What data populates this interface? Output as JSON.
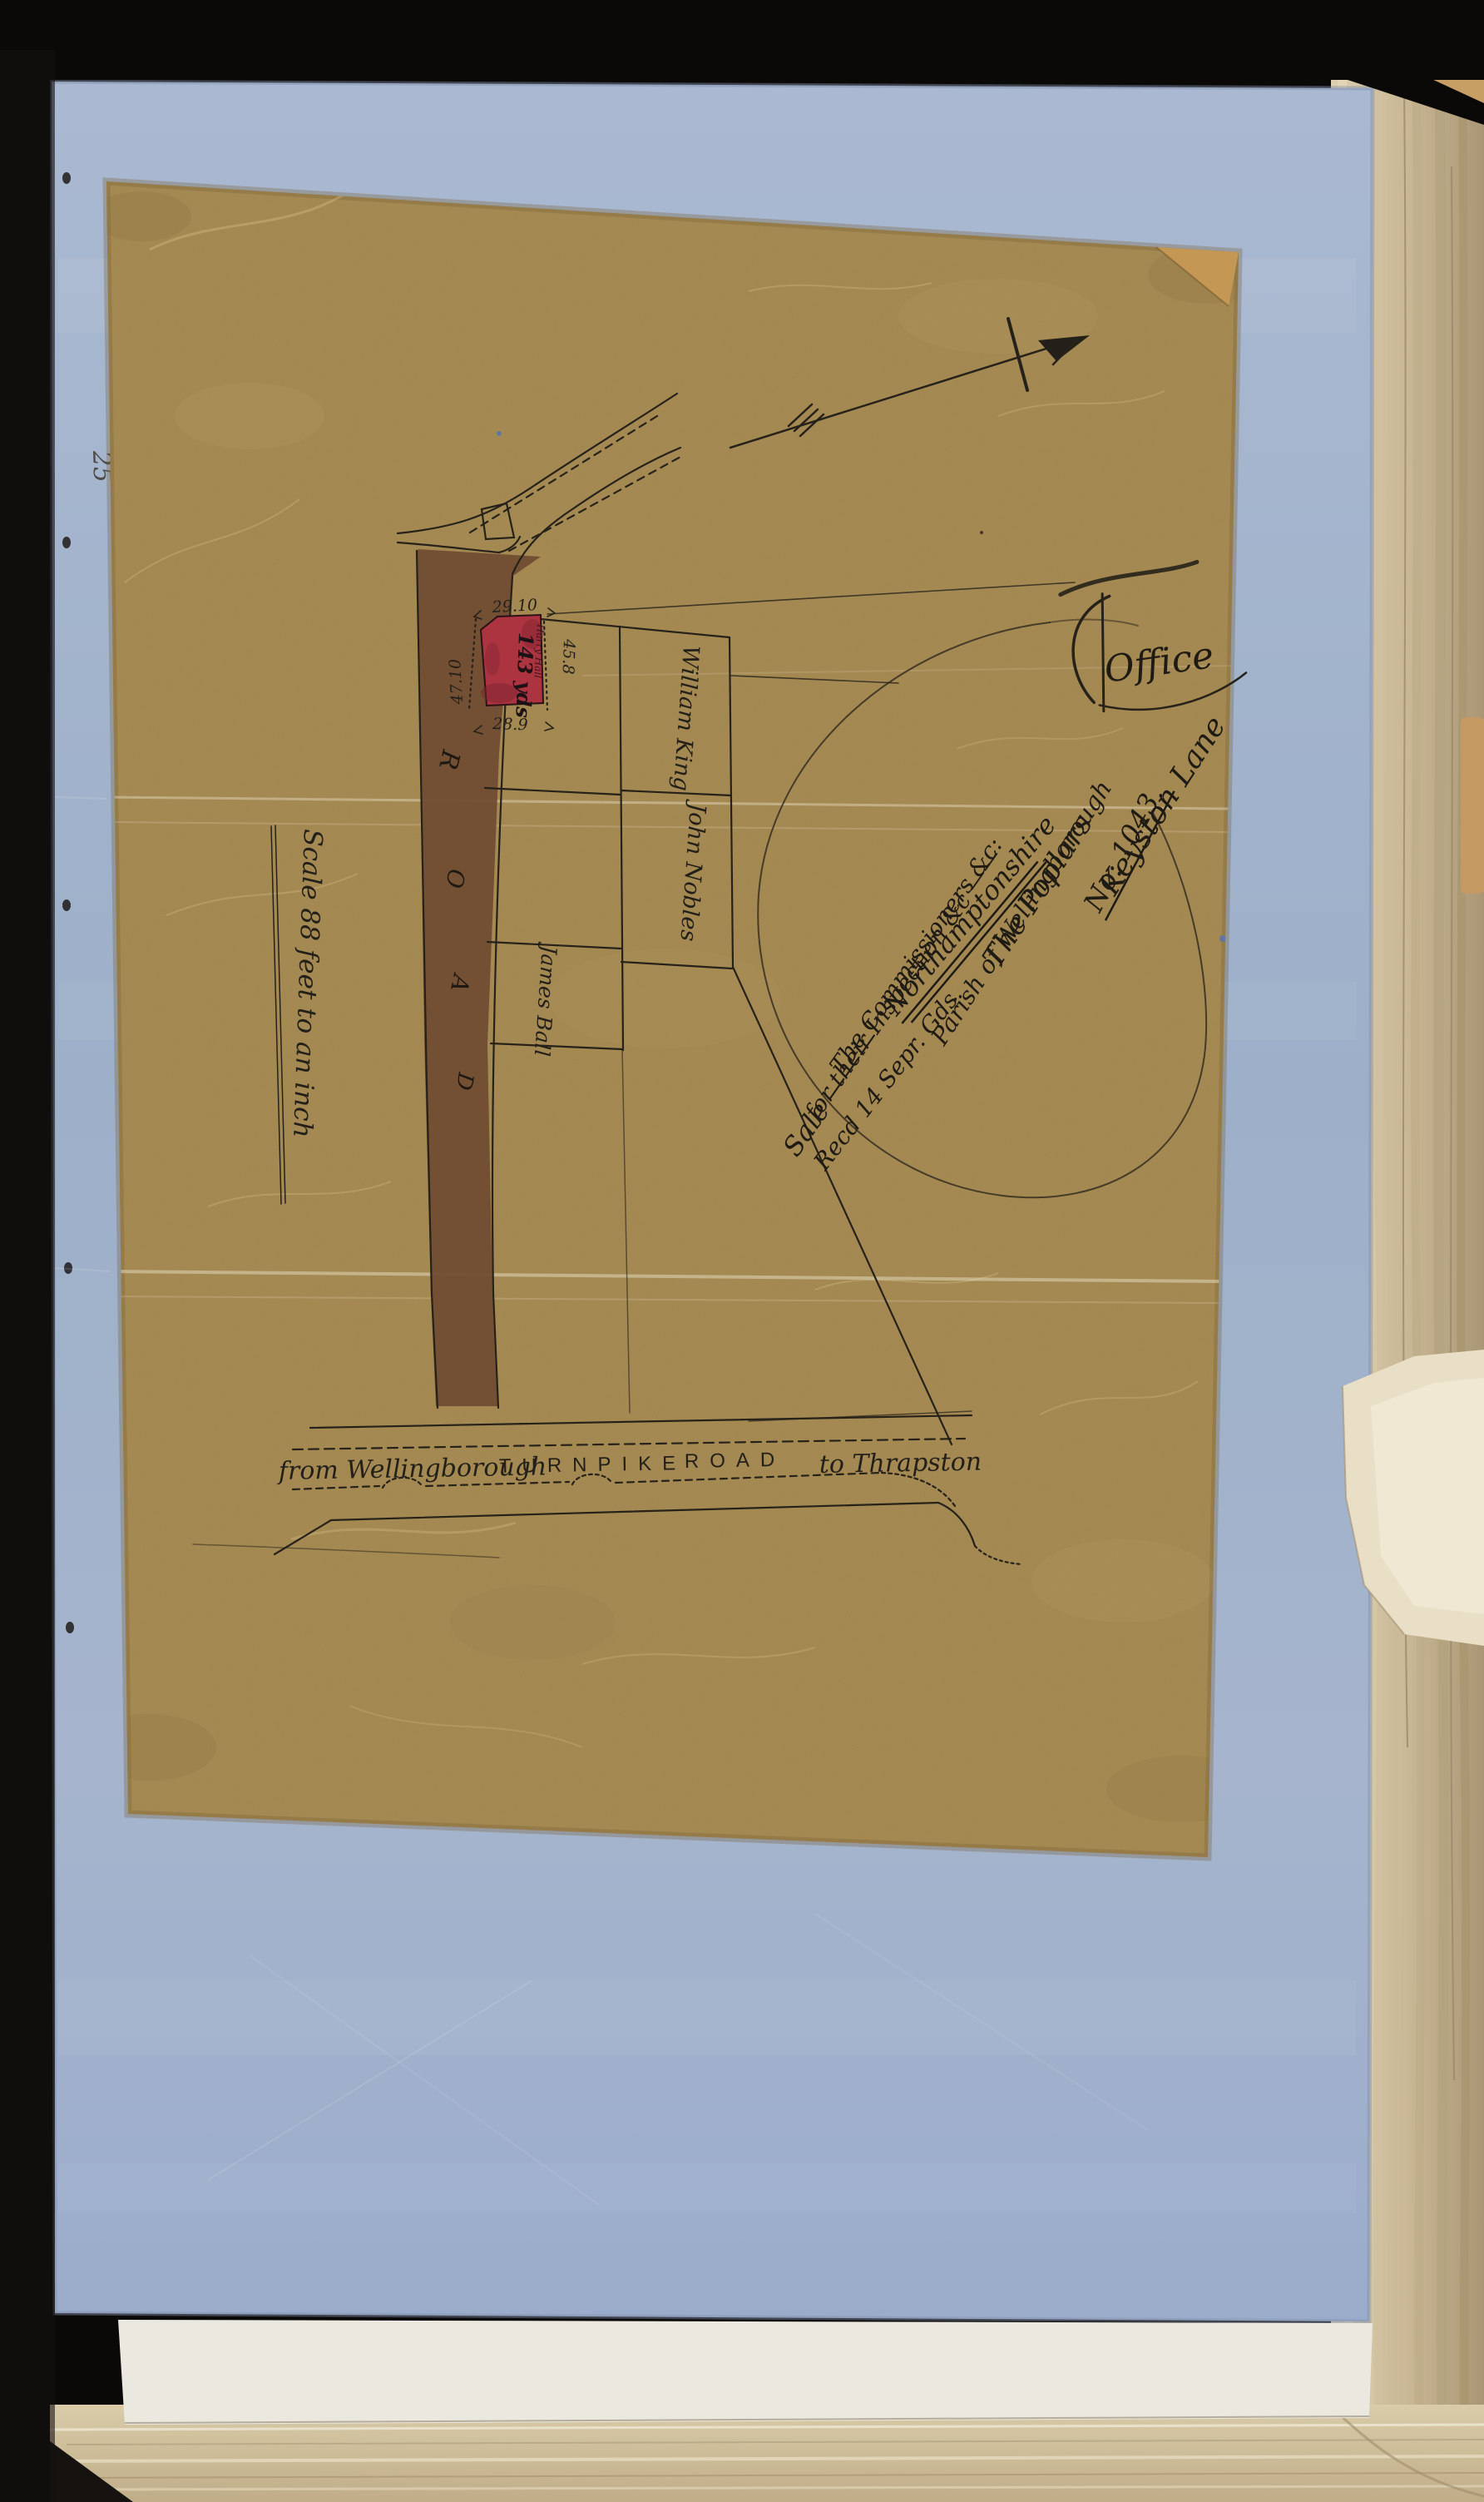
{
  "colors": {
    "backdrop": "#0b0908",
    "blue_paper": "#a3b2cb",
    "plan_paper": "#a1854e",
    "road_wash": "#6f4b31",
    "red_plot": "#ac3340",
    "ink": "#23201a",
    "book_pages": "#c9b795"
  },
  "margin": {
    "pencil_mark": "25"
  },
  "docket": {
    "office_mark": "Office",
    "lines": [
      "Keyston Lane",
      "No: 1043.",
      "The  Poplars",
      "Parish of Wellingborough",
      "Northamptonshire",
      "The Commissioners &c:",
      "for their Inspection &c ——",
      "Sale ———",
      "Recd 14 Sepr. Gds."
    ]
  },
  "plan": {
    "scale_note": "Scale 88 feet to an inch",
    "road_letters": [
      "R",
      "O",
      "A",
      "D"
    ],
    "turnpike": {
      "from_label": "from Wellingborough",
      "name_word1": "TURNPIKE",
      "name_word2": "ROAD",
      "to_label": "to Thrapston"
    },
    "owners": [
      "William King",
      "John Nobles",
      "James Ball"
    ],
    "red_plot": {
      "area_label": "143 yds",
      "tenant_note": "Harry Hall",
      "dim_top": "29.10",
      "dim_bottom": "28.9",
      "dim_left": "47.10",
      "dim_right": "45.8"
    }
  }
}
